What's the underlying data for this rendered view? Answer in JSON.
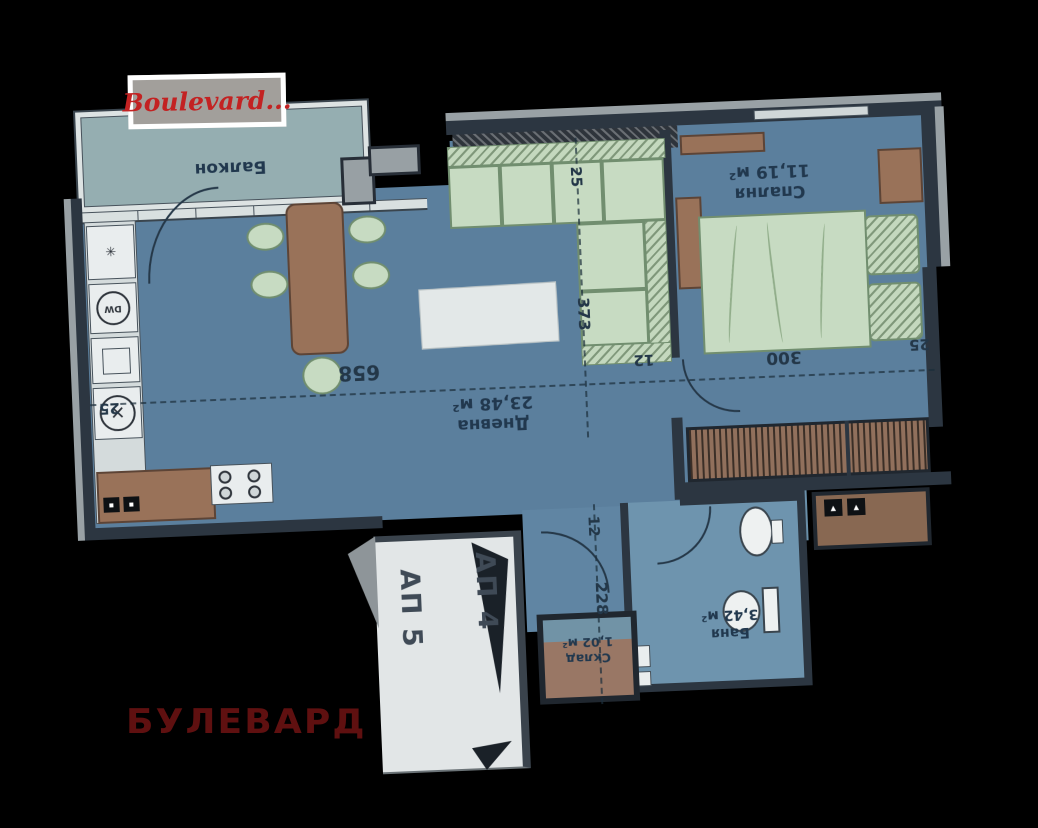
{
  "watermark": {
    "text": "Boulevard..."
  },
  "brand_text": "БУЛЕВАРД",
  "rooms": {
    "balcony": {
      "name": "Балкон"
    },
    "living": {
      "name": "Дневна",
      "area": "23,48 м²"
    },
    "bedroom": {
      "name": "Спалня",
      "area": "11,19 м²"
    },
    "bath": {
      "name": "Баня",
      "area": "3,42 м²"
    },
    "storage": {
      "name": "Склад",
      "area": "1,02 м²"
    }
  },
  "units": {
    "ap4": "АП 4",
    "ap5": "АП 5"
  },
  "dims": {
    "kitchen_wall": "25",
    "sofa_inset": "25",
    "living_depth": "373",
    "living_width": "658",
    "door_width": "12",
    "bedroom_width": "300",
    "bedroom_wall": "25",
    "passage_width": "12",
    "entry_depth": "228"
  },
  "icons": {
    "dishwasher_label": "DW",
    "sink_cross": "✕",
    "hob_star": "✳",
    "panel_mark": "▪",
    "shaft_mark": "▲"
  },
  "colors": {
    "background": "#000000",
    "room_fill": "#587fa0",
    "balcony_fill": "#93aeb2",
    "wall": "#2b3642",
    "furniture_green": "#c6dcc0",
    "furniture_brown": "#9c7156",
    "corridor_fill": "#e2e6e7",
    "label_ink": "#1f3850",
    "watermark_red": "#c32222",
    "brand_red": "#5f1010"
  }
}
